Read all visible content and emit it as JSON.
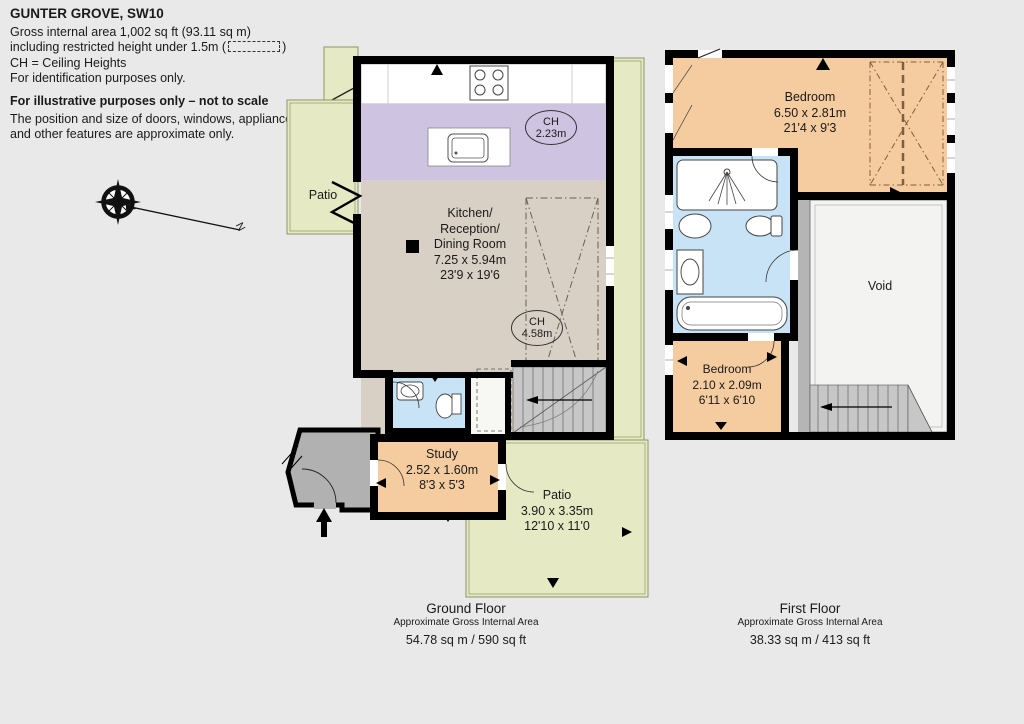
{
  "header": {
    "title": "GUNTER GROVE, SW10",
    "line1": "Gross internal area 1,002 sq ft (93.11 sq m)",
    "line2_prefix": "including restricted height under 1.5m (",
    "line2_suffix": ")",
    "line3": "CH =  Ceiling Heights",
    "line4": "For identification purposes only.",
    "note_title": "For illustrative purposes only – not to scale",
    "note_line1": "The position and size of doors, windows, appliances",
    "note_line2": "and other features are approximate only."
  },
  "compass": {
    "label": "N"
  },
  "ground_floor": {
    "patio_left_label": "Patio",
    "kitchen": {
      "name": "Kitchen/\nReception/\nDining Room",
      "metric": "7.25 x 5.94m",
      "imperial": "23'9 x 19'6"
    },
    "ch_upper": {
      "prefix": "CH",
      "value": "2.23m"
    },
    "ch_lower": {
      "prefix": "CH",
      "value": "4.58m"
    },
    "study": {
      "name": "Study",
      "metric": "2.52 x 1.60m",
      "imperial": "8'3 x 5'3"
    },
    "patio": {
      "name": "Patio",
      "metric": "3.90 x 3.35m",
      "imperial": "12'10 x 11'0"
    },
    "footer": {
      "title": "Ground Floor",
      "subtitle": "Approximate Gross Internal Area",
      "area": "54.78 sq m / 590 sq ft"
    }
  },
  "first_floor": {
    "bedroom": {
      "name": "Bedroom",
      "metric": "6.50 x 2.81m",
      "imperial": "21'4 x 9'3"
    },
    "bedroom2": {
      "name": "Bedroom",
      "metric": "2.10 x 2.09m",
      "imperial": "6'11 x 6'10"
    },
    "void_label": "Void",
    "footer": {
      "title": "First Floor",
      "subtitle": "Approximate Gross Internal Area",
      "area": "38.33 sq m / 413 sq ft"
    }
  },
  "colors": {
    "wall": "#000000",
    "patio_green": "#e6eac4",
    "patio_border": "#8f9566",
    "kitchen_lavender": "#cfc3e2",
    "reception_beige": "#d9d0c5",
    "bedroom_peach": "#f5cc9f",
    "bathroom_blue": "#c9e3f6",
    "hall_gray": "#b1b1b1",
    "stairs_gray": "#c7c7c7",
    "void_fill": "#f3f3f2"
  }
}
